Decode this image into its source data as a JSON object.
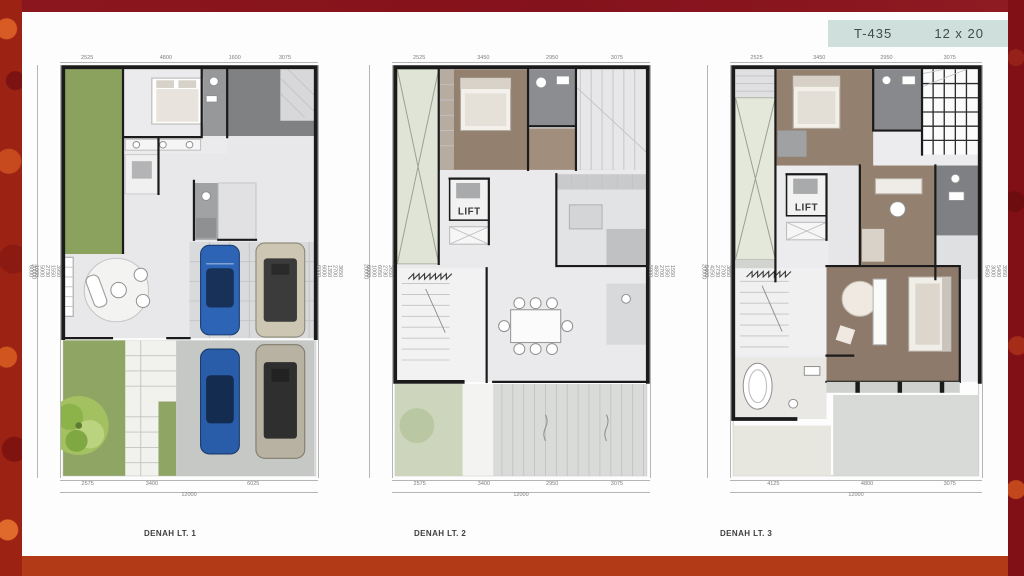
{
  "header": {
    "code": "T-435",
    "size": "12 x 20"
  },
  "colors": {
    "badge_bg": "#cfe0dc",
    "badge_text": "#424b49",
    "frame_maroon": "#8c161d",
    "frame_orange": "#b33a17"
  },
  "plans": [
    {
      "label": "DENAH LT. 1",
      "dims_top": [
        "2525",
        "4800",
        "1600",
        "3075"
      ],
      "dims_bottom": [
        "2575",
        "3400",
        "6025"
      ],
      "total_width": "12000",
      "dims_left": [
        "3950",
        "1550",
        "2730",
        "5000",
        "1000",
        "6000"
      ],
      "total_depth": "20000",
      "dims_right": [
        "3650",
        "2700",
        "1350",
        "6000",
        "6000"
      ]
    },
    {
      "label": "DENAH LT. 2",
      "lift": "LIFT",
      "dims_top": [
        "2525",
        "3450",
        "2950",
        "3075"
      ],
      "dims_bottom": [
        "2575",
        "3400",
        "2950",
        "3075"
      ],
      "total_width": "12000",
      "dims_left": [
        "2650",
        "2730",
        "6050",
        "1000",
        "6000"
      ],
      "total_depth": "20000",
      "dims_right": [
        "1550",
        "1350",
        "2700",
        "4850",
        "5000"
      ]
    },
    {
      "label": "DENAH LT. 3",
      "lift": "LIFT",
      "dims_top": [
        "2525",
        "3450",
        "2950",
        "3075"
      ],
      "dims_bottom": [
        "4125",
        "4800",
        "3075"
      ],
      "total_width": "12000",
      "dims_left": [
        "3850",
        "2700",
        "2730",
        "4250",
        "5400"
      ],
      "total_depth": "20000",
      "dims_right": [
        "3950",
        "5400",
        "3000",
        "5450"
      ]
    }
  ]
}
